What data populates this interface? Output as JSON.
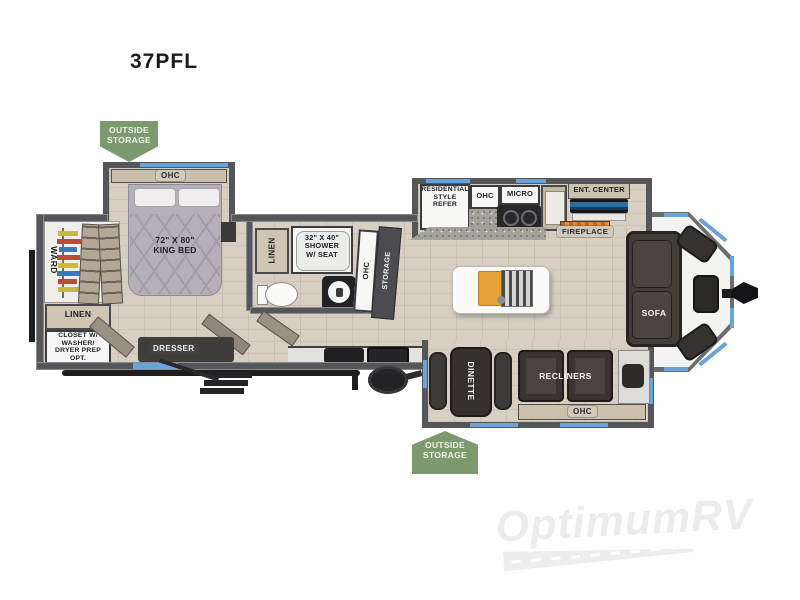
{
  "title": "37PFL",
  "badges": {
    "top": "OUTSIDE\nSTORAGE",
    "bottom": "OUTSIDE\nSTORAGE"
  },
  "bedroom": {
    "ohc": "OHC",
    "bed": "72\" X 80\"\nKING BED",
    "ward": "WARD",
    "linen": "LINEN",
    "closet": "CLOSET W/\nWASHER/\nDRYER PREP\nOPT.",
    "dresser": "DRESSER"
  },
  "bath": {
    "linen": "LINEN",
    "shower": "32\" X 40\"\nSHOWER\nW/ SEAT",
    "ohc": "OHC",
    "storage": "STORAGE"
  },
  "kitchen": {
    "refer": "RESIDENTIAL\nSTYLE\nREFER",
    "ohc": "OHC",
    "micro": "MICRO",
    "ent_center": "ENT. CENTER",
    "fireplace": "FIREPLACE"
  },
  "living": {
    "dinette": "DINETTE",
    "recliners": "RECLINERS",
    "ohc": "OHC",
    "sofa": "SOFA"
  },
  "watermark": "OptimumRV",
  "colors": {
    "accent_blue": "#6aa3d8",
    "wall_gray": "#55565a",
    "floor_tan": "#d7cfc2",
    "badge_green": "#7d9a6e",
    "fireplace_orange": "#e07a1f",
    "tv_blue": "#2f6ea5",
    "cutting_board_orange": "#e8a23c"
  }
}
